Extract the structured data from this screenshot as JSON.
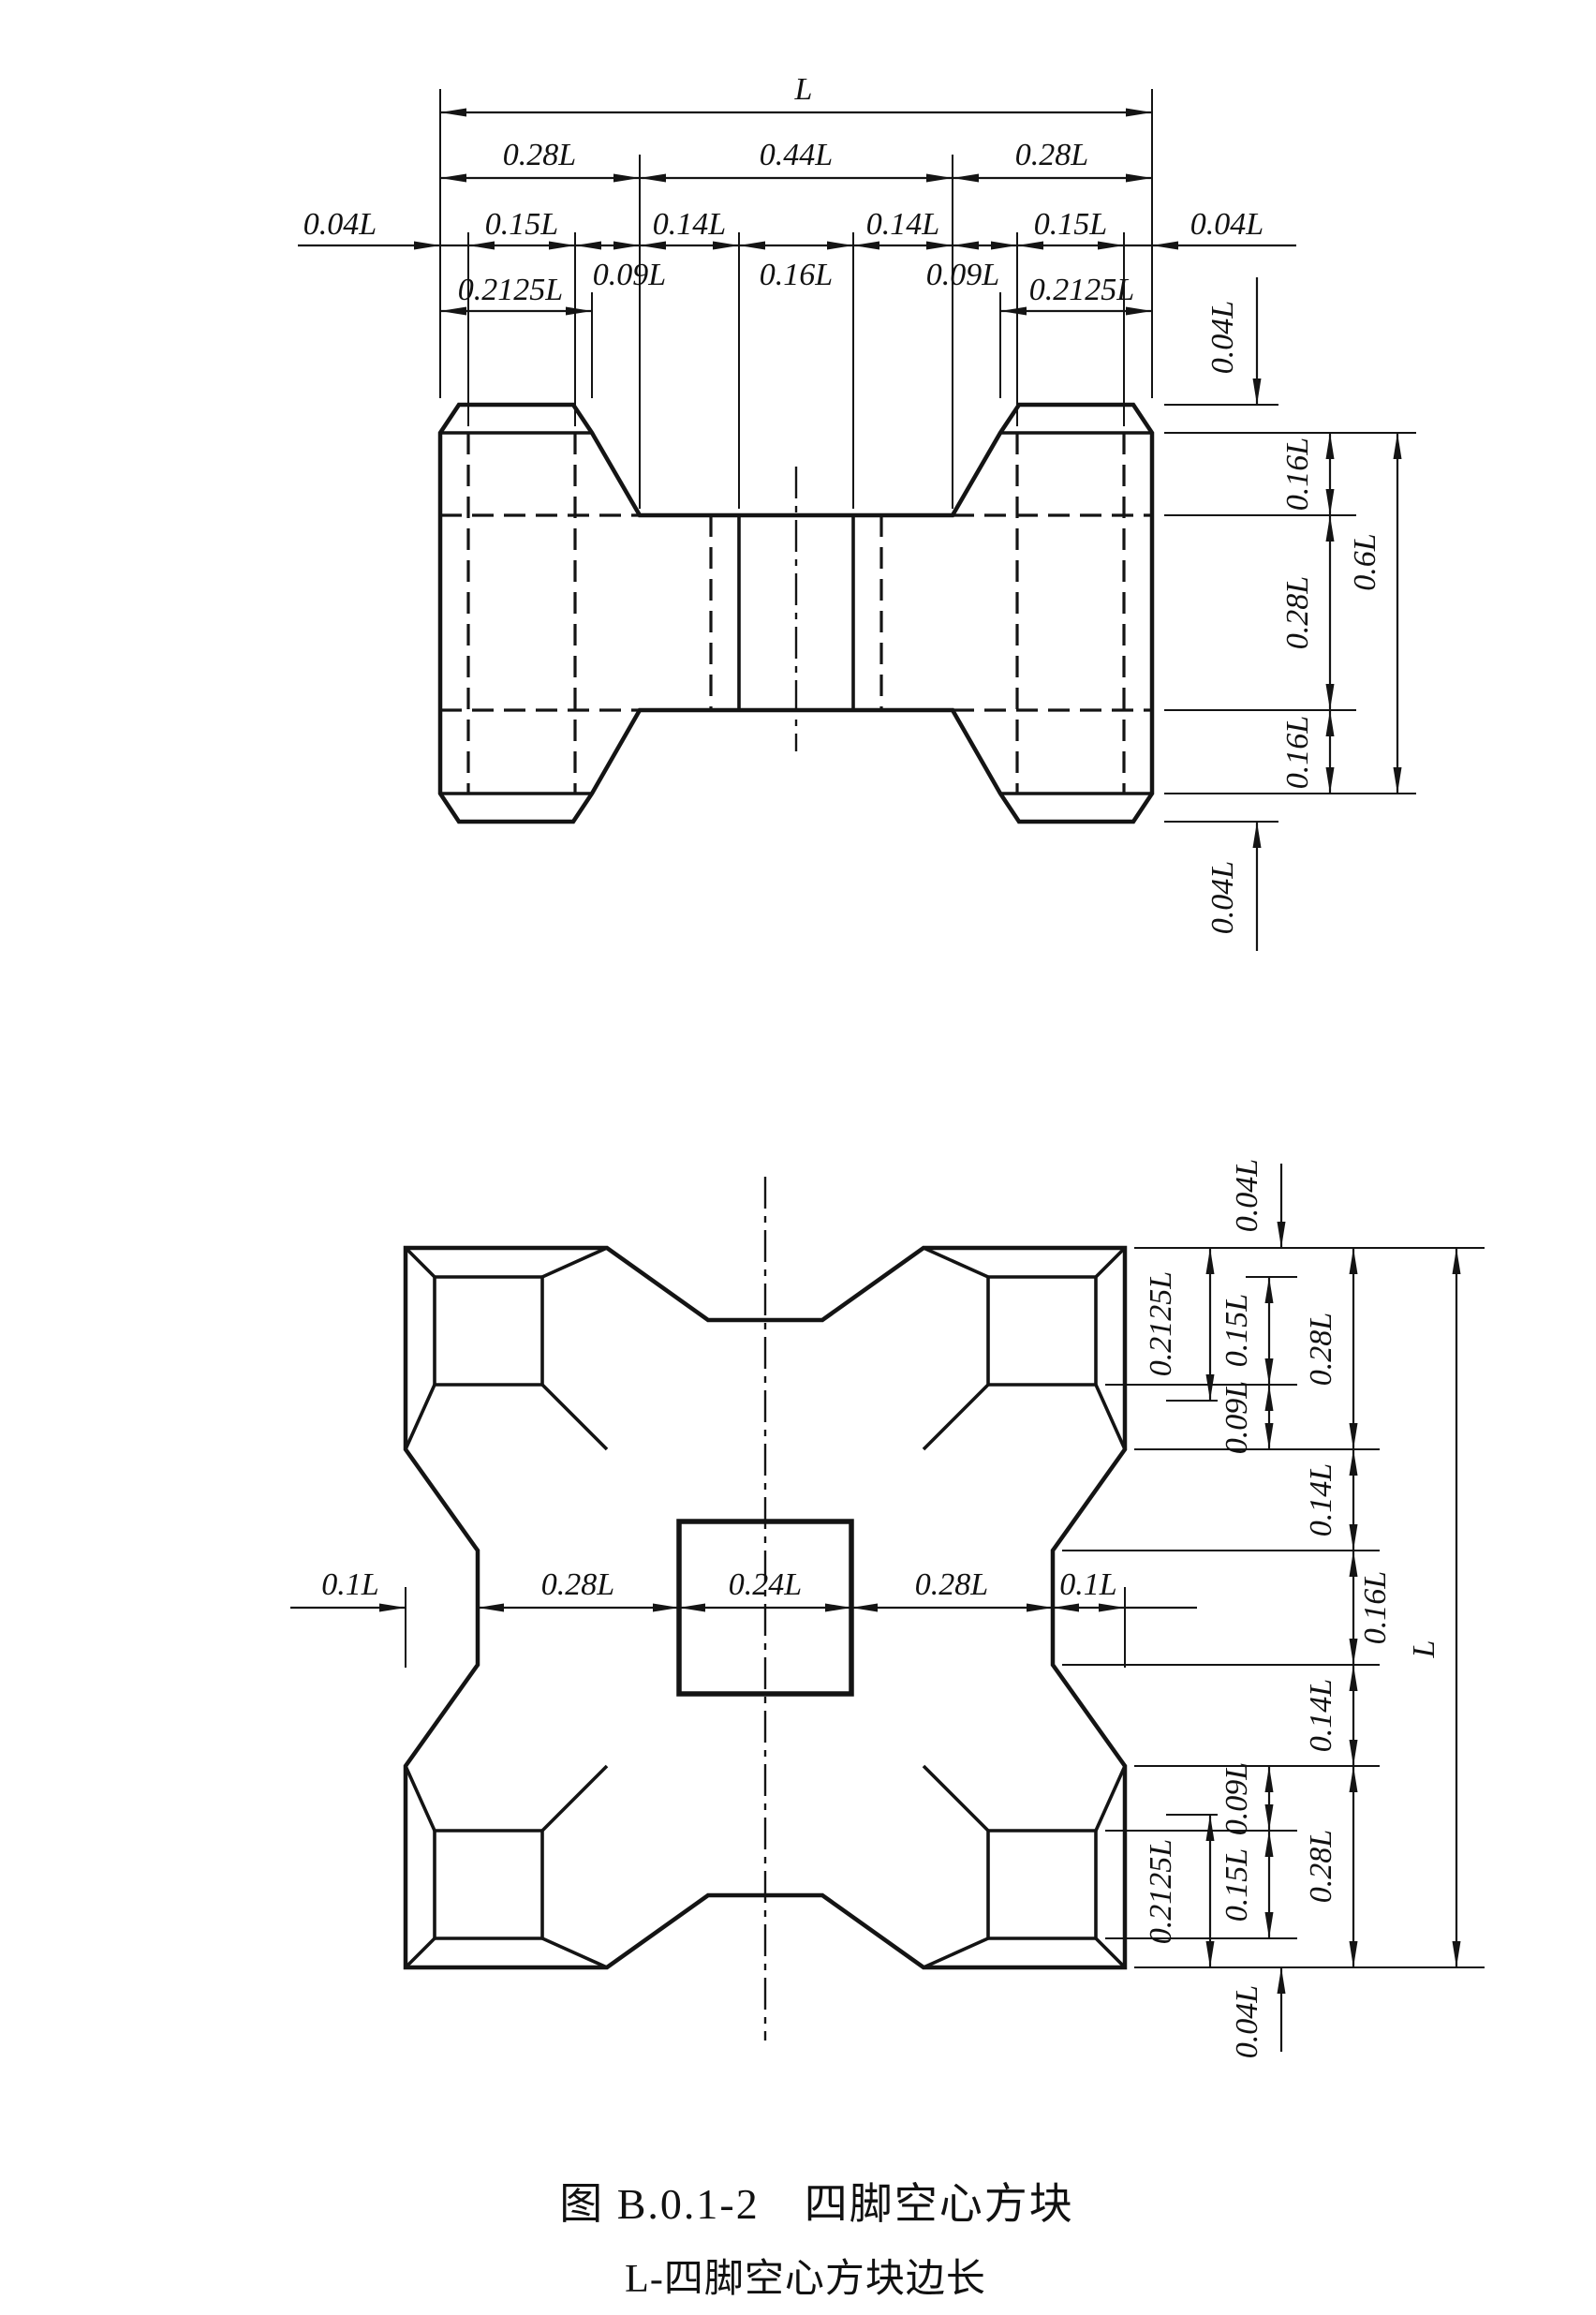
{
  "caption": {
    "line1": "图 B.0.1-2　四脚空心方块",
    "line2": "L-四脚空心方块边长"
  },
  "elevation": {
    "dim_total": "L",
    "top": {
      "left": "0.28L",
      "middle": "0.44L",
      "right": "0.28L"
    },
    "chain": {
      "cap_left": "0.04L",
      "hole_left": "0.15L",
      "web_left": "0.09L",
      "inner_left": "0.14L",
      "center": "0.16L",
      "inner_right": "0.14L",
      "web_right": "0.09L",
      "hole_right": "0.15L",
      "cap_right": "0.04L"
    },
    "leg_top_left": "0.2125L",
    "leg_top_right": "0.2125L",
    "right": {
      "cap_top": "0.04L",
      "band_top": "0.16L",
      "slab": "0.28L",
      "overall": "0.6L",
      "band_bottom": "0.16L",
      "cap_bottom": "0.04L"
    }
  },
  "plan": {
    "center_row": {
      "offset_left": "0.1L",
      "left": "0.28L",
      "center": "0.24L",
      "right": "0.28L",
      "offset_right": "0.1L"
    },
    "right": {
      "cap_top": "0.04L",
      "leg_face_top": "0.2125L",
      "hole_top": "0.15L",
      "web_top": "0.09L",
      "leg_top": "0.28L",
      "inner_top": "0.14L",
      "center": "0.16L",
      "inner_bottom": "0.14L",
      "leg_bottom": "0.28L",
      "web_bottom": "0.09L",
      "hole_bottom": "0.15L",
      "leg_face_bottom": "0.2125L",
      "cap_bottom": "0.04L",
      "overall": "L"
    }
  }
}
